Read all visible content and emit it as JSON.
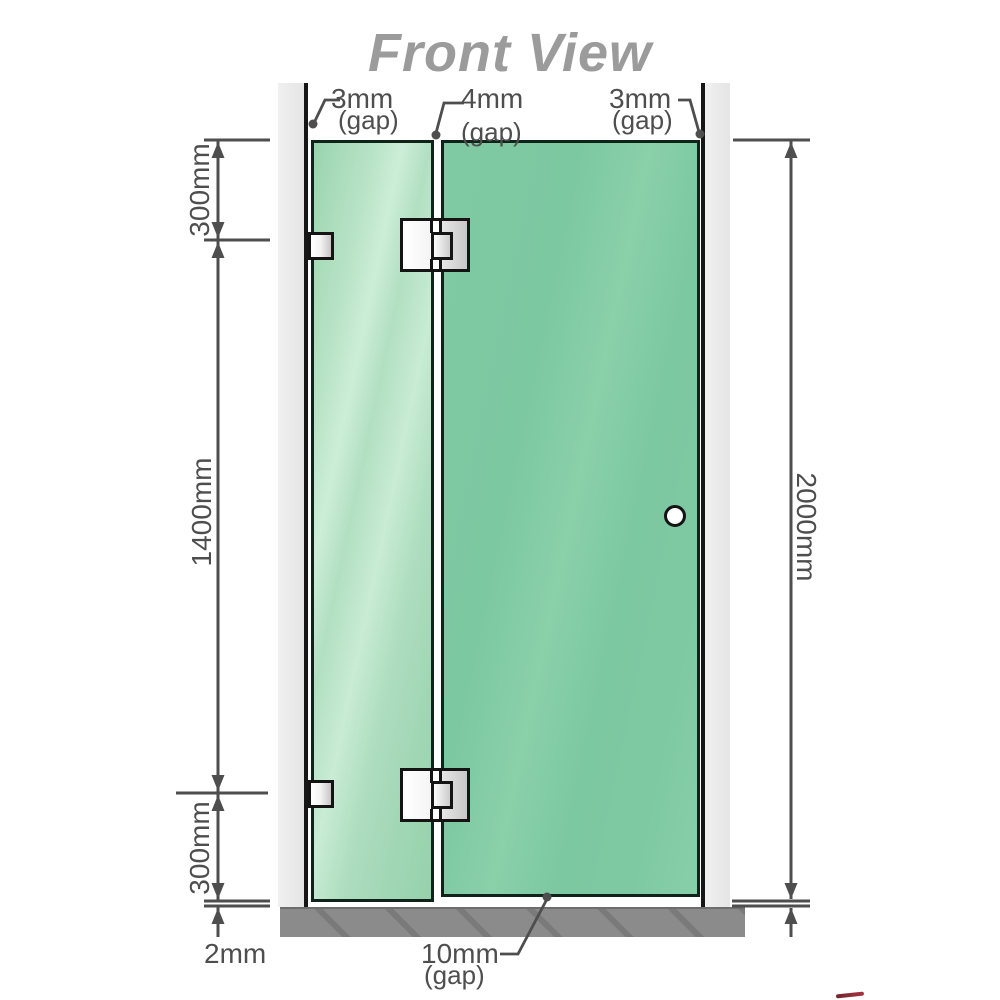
{
  "title": "Front View",
  "diagram": {
    "gaps": {
      "left": {
        "value": "3mm",
        "caption": "(gap)"
      },
      "middle": {
        "value": "4mm",
        "caption": "(gap)"
      },
      "right": {
        "value": "3mm",
        "caption": "(gap)"
      },
      "bottom": {
        "value": "10mm",
        "caption": "(gap)"
      }
    },
    "dimensions": {
      "top_left": "300mm",
      "left": "1400mm",
      "bottom_left": "300mm",
      "base_clearance": "2mm",
      "right_height": "2000mm"
    },
    "colors": {
      "glass_fixed_panel": "#aedec0",
      "glass_door_panel": "#7cc8a1",
      "wall_channel": "#e9e9e9",
      "floor_base": "#8b8b8b",
      "dimension_lines": "#4e4e4e",
      "title_text": "#9b9b9b",
      "hardware_metal": "#d9d9d9"
    }
  }
}
